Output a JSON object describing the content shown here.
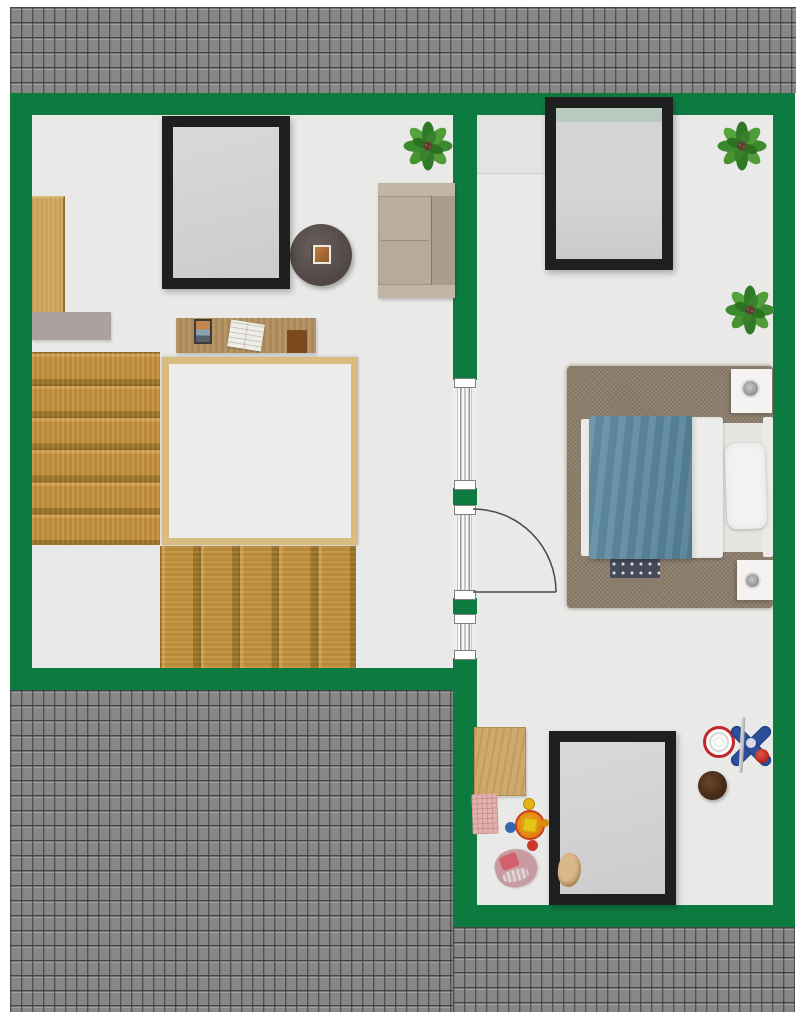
{
  "plan_title": "Attic floor plan",
  "palette": {
    "wall_green": "#0d7b40",
    "roof_gray": "#8e8e8e",
    "floor_light": "#e9e9e8",
    "stair_wood": "#c3913c",
    "duvet_blue": "#5d89a0",
    "rug_brown": "#8c7d6b",
    "skylight_frame": "#1f1f1f"
  },
  "names": {
    "plan": "Attic floor plan",
    "roof": "Roof tiles",
    "wall": "Wall",
    "floor": "Floor",
    "dormer": "Dormer recess",
    "partition": "Glazed partition",
    "door": "Swing door",
    "skylight": "Roof window",
    "stairs_upper": "Staircase upper flight",
    "stairs_lower": "Staircase lower flight",
    "stairwell": "Stairwell opening",
    "wardrobe": "Wardrobe",
    "sideboard": "Sideboard",
    "desk": "Desk",
    "desk_photo": "Photo",
    "book": "Open book",
    "desk_pad": "Desk pad",
    "side_table": "Round side table",
    "tray": "Tray with picture",
    "sofa": "Sofa",
    "plant": "Potted plant",
    "rug": "Area rug",
    "mini_rug": "Small patterned rug",
    "bed": "Double bed",
    "duvet": "Blue duvet",
    "sheet": "Folded sheet",
    "pillow": "Pillow",
    "headboard": "Headboard",
    "foot_rail": "Foot rail",
    "nightstand": "Nightstand",
    "lamp": "Table lamp",
    "play_mat": "Wooden play mat",
    "baby_blanket": "Baby blanket",
    "spin_toy": "Spinning toy",
    "baby_toy": "Baby toy",
    "hoop": "Toy basketball hoop",
    "pouf": "Pouf",
    "teddy": "Teddy bear"
  },
  "rooms": [
    {
      "name": "Landing / study",
      "contents": [
        "staircase",
        "stairwell opening",
        "wardrobe",
        "sideboard",
        "desk",
        "open book",
        "photo",
        "desk pad",
        "round side table",
        "sofa",
        "roof window",
        "potted plant"
      ]
    },
    {
      "name": "Bedroom",
      "contents": [
        "double bed",
        "blue duvet",
        "pillow",
        "area rug",
        "small rug",
        "2 nightstands",
        "2 table lamps",
        "roof window",
        "2 potted plants"
      ]
    },
    {
      "name": "Play corner",
      "contents": [
        "wooden play mat",
        "baby blanket",
        "spinning toy",
        "baby toy",
        "toy basketball hoop",
        "pouf",
        "roof window",
        "teddy bear"
      ]
    }
  ],
  "openings": {
    "skylights_count": 3,
    "door_count": 1,
    "glazed_panels_count": 3
  }
}
